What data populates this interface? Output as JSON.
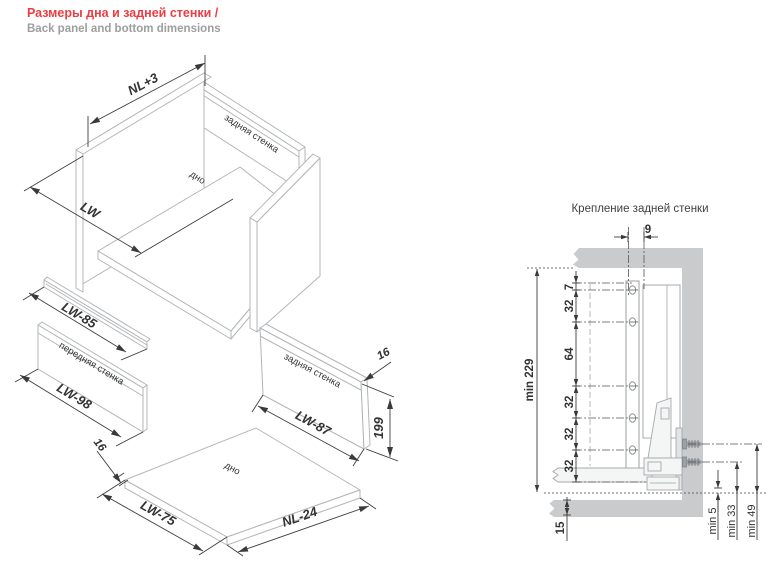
{
  "header": {
    "title_ru": "Размеры дна и задней стенки /",
    "title_en": "Back panel and bottom dimensions"
  },
  "exploded": {
    "assembly": {
      "dim_depth": "NL+3",
      "dim_width": "LW",
      "back_panel_label": "задняя стенка",
      "bottom_label": "дно"
    },
    "rail": {
      "dim_width": "LW-85"
    },
    "front_panel": {
      "label": "передняя стенка",
      "dim_width": "LW-98"
    },
    "back_panel": {
      "label": "задняя стенка",
      "dim_width": "LW-87",
      "dim_height": "199",
      "dim_thickness": "16"
    },
    "bottom_panel": {
      "label": "дно",
      "dim_width": "LW-75",
      "dim_depth": "NL-24",
      "dim_thickness": "16"
    }
  },
  "section": {
    "title": "Крепление задней стенки",
    "dim_offset": "9",
    "stack": [
      "7",
      "32",
      "64",
      "32",
      "32",
      "32"
    ],
    "dim_overall": "min 229",
    "dim_bottom": "15",
    "dim_min5": "min 5",
    "dim_min33": "min 33",
    "dim_min49": "min 49"
  },
  "colors": {
    "accent_red": "#ee3d42",
    "subtitle_gray": "#9e9e9e",
    "panel_gray": "#c9cbcd",
    "line_gray": "#b2b6b9",
    "dim_dark": "#3a3a3a"
  }
}
